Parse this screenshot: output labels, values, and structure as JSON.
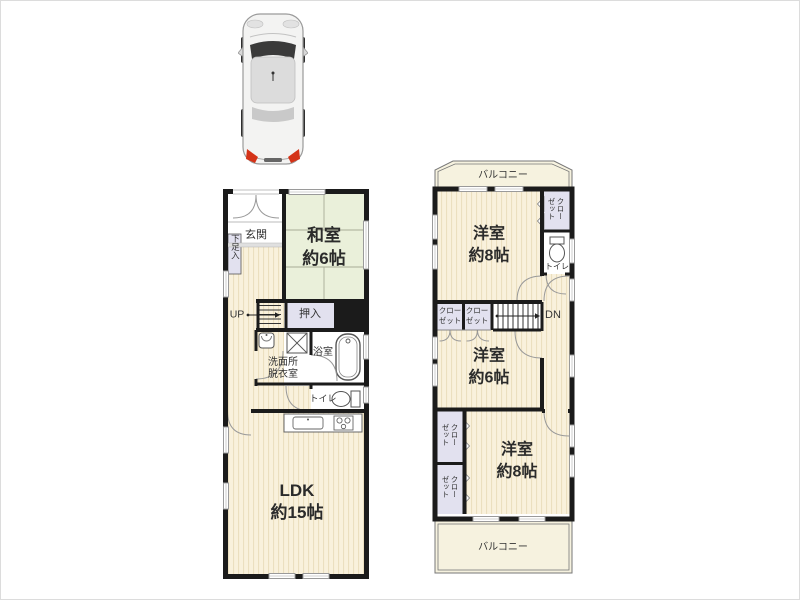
{
  "colors": {
    "wall": "#1b1b1b",
    "wood_base": "#f9f1dc",
    "wood_stripe": "#ebdfbf",
    "tatami": "#eaf0da",
    "closet_fill": "#e2e1ef",
    "balcony_fill": "#f6f2df",
    "taillight_red": "#d43318"
  },
  "floor1": {
    "entrance": {
      "label": "玄関"
    },
    "shoe_cabinet": {
      "label": "下足入"
    },
    "japanese_room": {
      "name": "和室",
      "size": "約6帖"
    },
    "stairs": {
      "label": "UP"
    },
    "oshiire": {
      "label": "押入"
    },
    "washroom": {
      "line1": "洗面所",
      "line2": "脱衣室"
    },
    "bathroom": {
      "label": "浴室"
    },
    "toilet": {
      "label": "トイレ"
    },
    "ldk": {
      "name": "LDK",
      "size": "約15帖"
    }
  },
  "floor2": {
    "balcony_top": {
      "label": "バルコニー"
    },
    "bedroom_top": {
      "name": "洋室",
      "size": "約8帖"
    },
    "closet_top_right": {
      "label": "クローゼット"
    },
    "toilet": {
      "label": "トイレ"
    },
    "stairs": {
      "label": "DN"
    },
    "closet_a": {
      "line1": "クロー",
      "line2": "ゼット"
    },
    "closet_b": {
      "line1": "クロー",
      "line2": "ゼット"
    },
    "bedroom_mid": {
      "name": "洋室",
      "size": "約6帖"
    },
    "closet_c": {
      "label": "クローゼット"
    },
    "closet_d": {
      "label": "クローゼット"
    },
    "bedroom_bottom": {
      "name": "洋室",
      "size": "約8帖"
    },
    "balcony_bottom": {
      "label": "バルコニー"
    }
  }
}
